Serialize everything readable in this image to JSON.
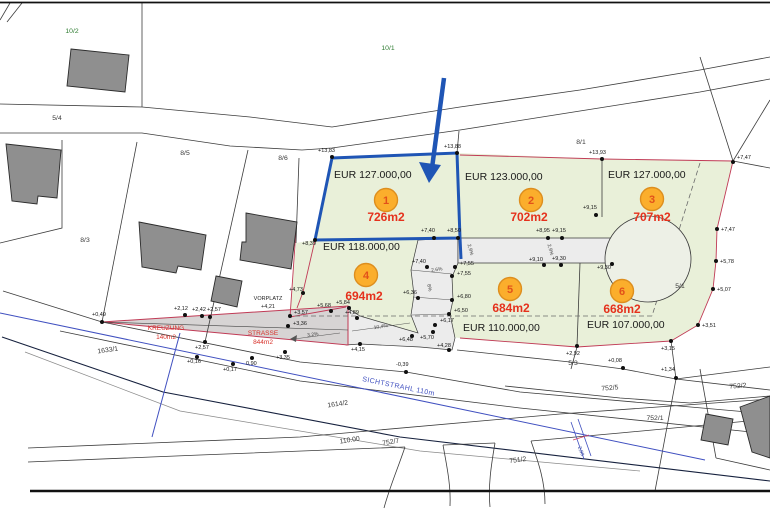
{
  "plots": [
    {
      "id": "1",
      "area": "726m2",
      "price": "EUR 127.000,00",
      "badge": [
        386,
        200
      ],
      "area_pos": [
        386,
        221
      ],
      "price_pos": [
        334,
        178
      ]
    },
    {
      "id": "2",
      "area": "702m2",
      "price": "EUR 123.000,00",
      "badge": [
        531,
        200
      ],
      "area_pos": [
        529,
        221
      ],
      "price_pos": [
        465,
        180
      ]
    },
    {
      "id": "3",
      "area": "707m2",
      "price": "EUR 127.000,00",
      "badge": [
        652,
        199
      ],
      "area_pos": [
        652,
        221
      ],
      "price_pos": [
        608,
        178
      ]
    },
    {
      "id": "4",
      "area": "694m2",
      "price": "EUR 118.000,00",
      "badge": [
        366,
        275
      ],
      "area_pos": [
        364,
        300
      ],
      "price_pos": [
        323,
        250
      ]
    },
    {
      "id": "5",
      "area": "684m2",
      "price": "EUR 110.000,00",
      "badge": [
        510,
        289
      ],
      "area_pos": [
        511,
        312
      ],
      "price_pos": [
        463,
        331
      ]
    },
    {
      "id": "6",
      "area": "668m2",
      "price": "EUR 107.000,00",
      "badge": [
        622,
        291
      ],
      "area_pos": [
        622,
        313
      ],
      "price_pos": [
        587,
        328
      ]
    }
  ],
  "parcels": [
    [
      "10/2",
      72,
      33,
      0,
      "g"
    ],
    [
      "10/1",
      388,
      50,
      0,
      "g"
    ],
    [
      "5/4",
      57,
      120,
      0,
      "k"
    ],
    [
      "8/5",
      185,
      155,
      0,
      "k"
    ],
    [
      "8/6",
      283,
      160,
      0,
      "k"
    ],
    [
      "8/3",
      85,
      242,
      0,
      "k"
    ],
    [
      "8/1",
      581,
      144,
      0,
      "k"
    ],
    [
      "5/1",
      680,
      288,
      0,
      "k"
    ],
    [
      "5/3",
      573,
      365,
      0,
      "k"
    ],
    [
      "1633/1",
      108,
      352,
      -8,
      "k"
    ],
    [
      "1614/2",
      338,
      406,
      -8,
      "k"
    ],
    [
      "110.00",
      350,
      442,
      -9,
      "k"
    ],
    [
      "752/7",
      391,
      444,
      -9,
      "k"
    ],
    [
      "751/2",
      518,
      462,
      -7,
      "k"
    ],
    [
      "752/5",
      610,
      390,
      -4,
      "k"
    ],
    [
      "752/2",
      738,
      388,
      -4,
      "k"
    ],
    [
      "752/1",
      655,
      420,
      0,
      "k"
    ]
  ],
  "elevations": [
    [
      "+13,83",
      332,
      157,
      318,
      152
    ],
    [
      "+13,88",
      457,
      153,
      444,
      148
    ],
    [
      "+13,93",
      602,
      159,
      589,
      154
    ],
    [
      "+7,47",
      733,
      162,
      737,
      159
    ],
    [
      "+7,47",
      717,
      229,
      721,
      231
    ],
    [
      "+5,78",
      716,
      261,
      720,
      263
    ],
    [
      "+5,07",
      713,
      289,
      717,
      291
    ],
    [
      "+3,51",
      698,
      325,
      702,
      327
    ],
    [
      "+3,15",
      671,
      341,
      661,
      350
    ],
    [
      "+2,92",
      577,
      346,
      566,
      355
    ],
    [
      "+0,08",
      623,
      368,
      608,
      362
    ],
    [
      "+1,34",
      676,
      378,
      661,
      371
    ],
    [
      "+9,15",
      596,
      215,
      583,
      209
    ],
    [
      "+8,95",
      548,
      238,
      536,
      232
    ],
    [
      "+9,15",
      562,
      238,
      552,
      232
    ],
    [
      "+9,10",
      544,
      265,
      529,
      261
    ],
    [
      "+9,30",
      561,
      265,
      552,
      260
    ],
    [
      "+9,30",
      612,
      264,
      597,
      269
    ],
    [
      "+7,40",
      434,
      238,
      421,
      232
    ],
    [
      "+8,50",
      458,
      238,
      447,
      232
    ],
    [
      "+8,39",
      315,
      240,
      302,
      245
    ],
    [
      "+7,40",
      427,
      267,
      412,
      263
    ],
    [
      "+7,55",
      455,
      267,
      460,
      265
    ],
    [
      "+7,55",
      452,
      276,
      457,
      275
    ],
    [
      "+6,36",
      418,
      298,
      403,
      294
    ],
    [
      "+6,80",
      452,
      300,
      457,
      298
    ],
    [
      "+6,50",
      449,
      314,
      454,
      312
    ],
    [
      "+5,84",
      349,
      308,
      336,
      304
    ],
    [
      "+5,68",
      331,
      311,
      317,
      307
    ],
    [
      "+4,89",
      357,
      318,
      345,
      314
    ],
    [
      "+4,73",
      303,
      293,
      289,
      291
    ],
    [
      "+4,15",
      360,
      344,
      351,
      351
    ],
    [
      "+6,48",
      412,
      336,
      399,
      341
    ],
    [
      "+5,70",
      433,
      332,
      420,
      339
    ],
    [
      "+6,17",
      435,
      325,
      440,
      322
    ],
    [
      "+2,12",
      185,
      315,
      174,
      310
    ],
    [
      "+2,42",
      202,
      316,
      192,
      311
    ],
    [
      "+2,57",
      210,
      317,
      207,
      311
    ],
    [
      "+2,57",
      205,
      342,
      195,
      349
    ],
    [
      "+0,16",
      197,
      357,
      187,
      363
    ],
    [
      "+0,17",
      233,
      364,
      223,
      371
    ],
    [
      "0,90",
      252,
      358,
      246,
      365
    ],
    [
      "+3,35",
      285,
      352,
      276,
      359
    ],
    [
      "+3,57",
      290,
      316,
      294,
      314
    ],
    [
      "+3,36",
      288,
      326,
      293,
      325
    ],
    [
      "+0,49",
      102,
      322,
      92,
      316
    ],
    [
      "-0,39",
      406,
      372,
      396,
      366
    ],
    [
      "+4,28",
      449,
      350,
      437,
      347
    ]
  ],
  "slopes": [
    [
      "3,2%",
      313,
      336,
      -8
    ],
    [
      "10,4%",
      381,
      328,
      -9
    ],
    [
      "2,6%",
      437,
      271,
      -8
    ],
    [
      "8%",
      428,
      288,
      78
    ],
    [
      "2,9%",
      469,
      250,
      75
    ],
    [
      "2,9%",
      549,
      250,
      75
    ]
  ],
  "road_labels": {
    "kreuzung_name": "KREUZUNG",
    "kreuzung_area": "140m2",
    "strasse_name": "STRASSE",
    "strasse_area": "844m2",
    "vorplatz_name": "VORPLATZ",
    "vorplatz_elev": "+4,21",
    "sichtstrahl": "SICHTSTRAHL 110m",
    "dimension": "2,00"
  },
  "colors": {
    "plot_green": "#E9F0D9",
    "road_gray": "#ECECEC",
    "kreuzung_gray": "#D7D4D4",
    "boundary_red": "#C03A55",
    "highlight_blue": "#1F55B5",
    "badge_orange": "#FBAE2C",
    "badge_border": "#DD8E1E",
    "area_red": "#E5311C",
    "number_red": "#E2511A",
    "sight_blue": "#4050C0",
    "parcel_green": "#2F7D32"
  }
}
